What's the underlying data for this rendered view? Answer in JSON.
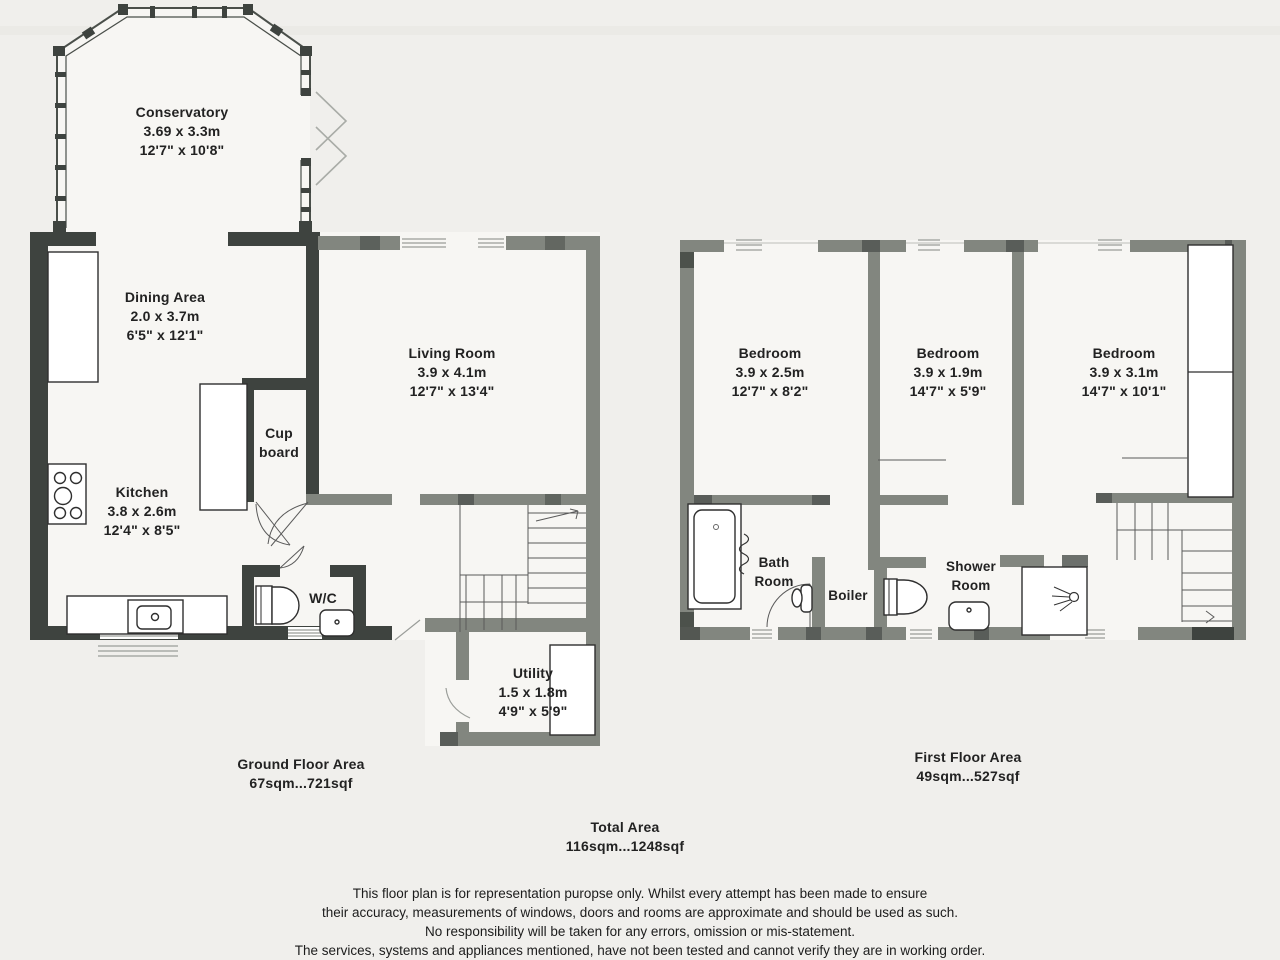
{
  "ground_floor": {
    "rooms": {
      "conservatory": {
        "name": "Conservatory",
        "metric": "3.69 x 3.3m",
        "imperial": "12'7\" x 10'8\""
      },
      "dining": {
        "name": "Dining Area",
        "metric": "2.0 x 3.7m",
        "imperial": "6'5\" x 12'1\""
      },
      "kitchen": {
        "name": "Kitchen",
        "metric": "3.8 x 2.6m",
        "imperial": "12'4\" x 8'5\""
      },
      "cupboard": {
        "line1": "Cup",
        "line2": "board"
      },
      "wc": {
        "name": "W/C"
      },
      "living": {
        "name": "Living Room",
        "metric": "3.9 x 4.1m",
        "imperial": "12'7\" x 13'4\""
      },
      "utility": {
        "name": "Utility",
        "metric": "1.5 x 1.8m",
        "imperial": "4'9\" x 5'9\""
      }
    },
    "area_label": "Ground Floor Area",
    "area_value": "67sqm...721sqf"
  },
  "first_floor": {
    "rooms": {
      "bedroom1": {
        "name": "Bedroom",
        "metric": "3.9 x 2.5m",
        "imperial": "12'7\" x 8'2\""
      },
      "bedroom2": {
        "name": "Bedroom",
        "metric": "3.9 x 1.9m",
        "imperial": "14'7\" x 5'9\""
      },
      "bedroom3": {
        "name": "Bedroom",
        "metric": "3.9 x 3.1m",
        "imperial": "14'7\" x 10'1\""
      },
      "bathroom": {
        "line1": "Bath",
        "line2": "Room"
      },
      "boiler": {
        "name": "Boiler"
      },
      "shower": {
        "line1": "Shower",
        "line2": "Room"
      }
    },
    "area_label": "First Floor Area",
    "area_value": "49sqm...527sqf"
  },
  "total": {
    "label": "Total Area",
    "value": "116sqm...1248sqf"
  },
  "disclaimer": [
    "This floor plan is for representation puropse only. Whilst every attempt has been made to ensure",
    "their accuracy, measurements of windows, doors and rooms are approximate and should be used as such.",
    "No responsibility will be taken for any errors, omission or mis-statement.",
    "The services, systems and appliances mentioned, have not been tested and cannot verify they are in working order."
  ],
  "colors": {
    "wall_dark": "#3e433f",
    "wall_gray": "#82867f",
    "paper": "#f0efec",
    "room_fill": "#f7f6f3",
    "text": "#222222"
  }
}
